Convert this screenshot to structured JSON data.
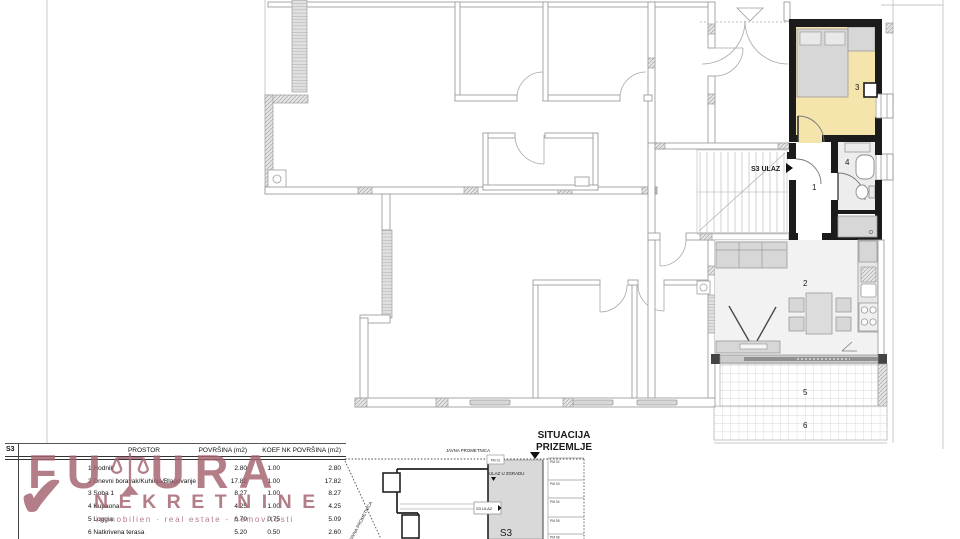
{
  "plan": {
    "entrance_label": "S3 ULAZ",
    "room_numbers": [
      "1",
      "2",
      "3",
      "4",
      "5",
      "6"
    ]
  },
  "table": {
    "unit": "S3",
    "headers": {
      "prostor": "PROSTOR",
      "povrsina": "POVRŠINA (m2)",
      "koef": "KOEF",
      "nk": "NK POVRŠINA (m2)"
    },
    "rows": [
      {
        "name": "1 Hodnik",
        "povrsina": "2.80",
        "koef": "1.00",
        "nk": "2.80"
      },
      {
        "name": "2 Dnevni boravak/Kuhinja/Blagovanje",
        "povrsina": "17.82",
        "koef": "1.00",
        "nk": "17.82"
      },
      {
        "name": "3 Soba 1",
        "povrsina": "8.27",
        "koef": "1.00",
        "nk": "8.27"
      },
      {
        "name": "4 Kupaona",
        "povrsina": "4.25",
        "koef": "1.00",
        "nk": "4.25"
      },
      {
        "name": "5 Loggia",
        "povrsina": "6.79",
        "koef": "0.75",
        "nk": "5.09"
      },
      {
        "name": "6 Natkrivena terasa",
        "povrsina": "5.20",
        "koef": "0.50",
        "nk": "2.60"
      }
    ]
  },
  "logo": {
    "part1": "FU",
    "part2": "URA",
    "line2": "NEKRETNINE",
    "tagline": "immobilien · real estate - nemovitosti",
    "check_glyph": "✔",
    "color": "#a4626e"
  },
  "situation": {
    "title_line1": "SITUACIJA",
    "title_line2": "PRIZEMLJE",
    "road_top": "JAVNA PROMETNICA",
    "road_diag": "JAVNA PROMETNICA",
    "building_entrance": "ULAZ U ZGRADU",
    "unit_entrance": "S3 ULAZ",
    "unit": "S3",
    "parking": [
      "PM 01",
      "PM 02",
      "PM 03",
      "PM 04",
      "PM 05",
      "PM 06"
    ]
  },
  "colors": {
    "highlight_room": "#f5e5ad",
    "dark_wall": "#1b1b1b",
    "logo": "#a4626e"
  }
}
